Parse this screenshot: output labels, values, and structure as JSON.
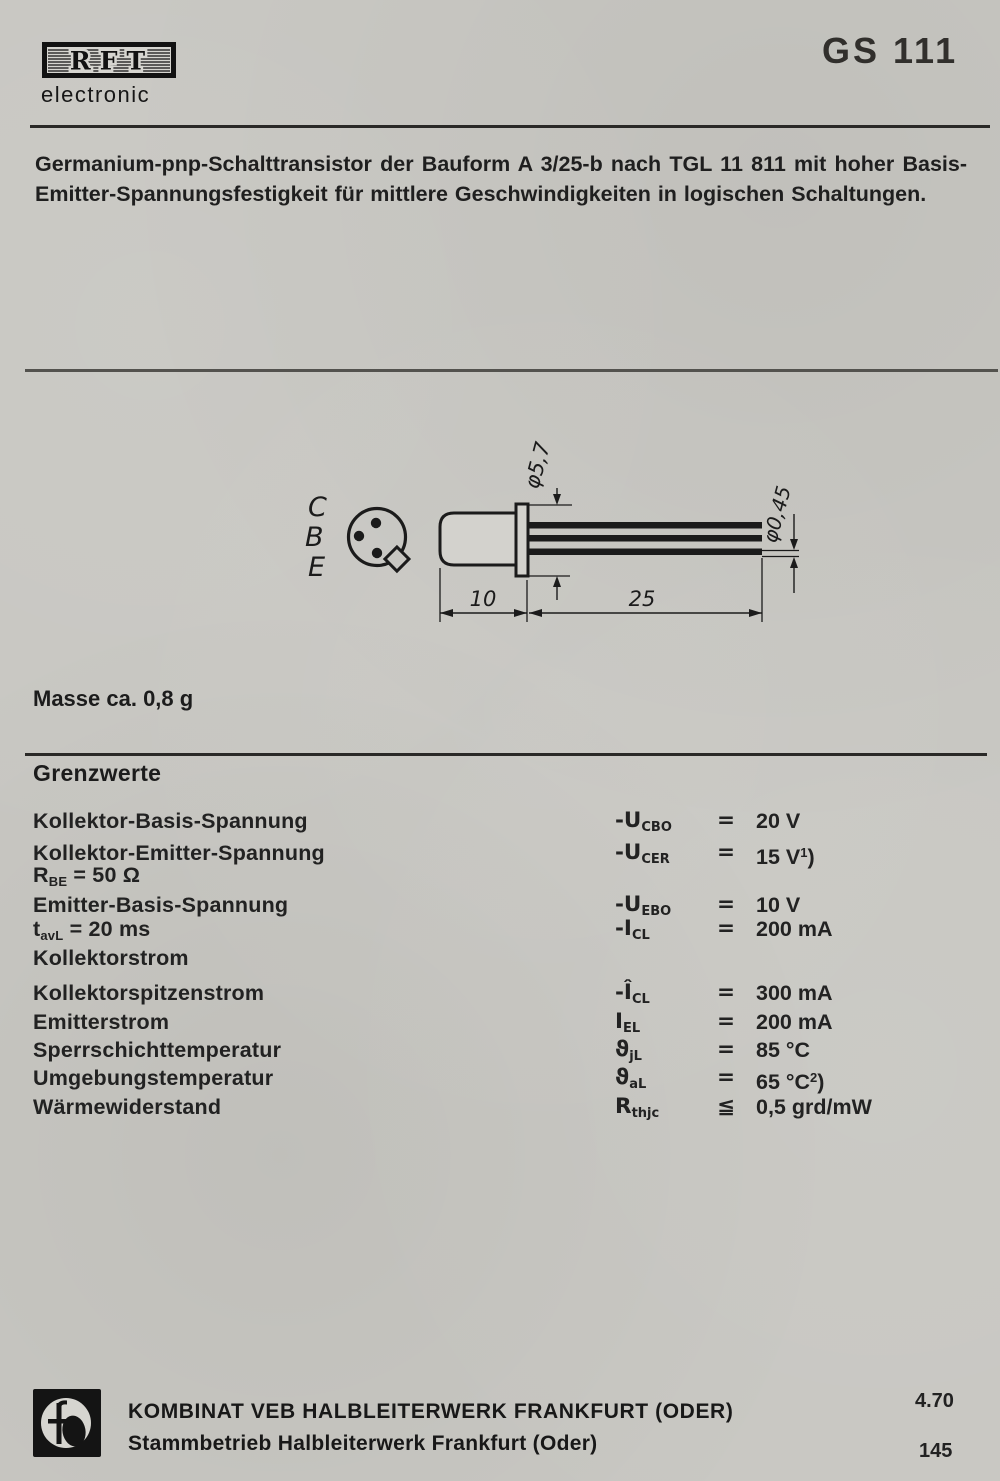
{
  "header": {
    "brand": "RFT",
    "brand_sub": "electronic",
    "part_number": "GS 111"
  },
  "description": {
    "lines": [
      "Germanium-pnp-Schalttransistor der Bauform A 3/25-b nach TGL 11 811 mit hoher Basis-",
      "Emitter-Spannungsfestigkeit für mittlere Geschwindigkeiten in logischen Schaltungen."
    ]
  },
  "diagram": {
    "pin_labels": [
      "C",
      "B",
      "E"
    ],
    "flange_diameter": "φ5,7",
    "lead_diameter": "φ0,45",
    "body_length": "10",
    "lead_length": "25"
  },
  "mass_note": "Masse ca. 0,8 g",
  "limits": {
    "title": "Grenzwerte",
    "rows": [
      {
        "label": "Kollektor-Basis-Spannung",
        "symbol": "-U~CBO~",
        "sign": "=",
        "value": "20 V"
      },
      {
        "label": "Kollektor-Emitter-Spannung",
        "symbol": "-U~CER~",
        "sign": "=",
        "value": "15 V^1^)"
      },
      {
        "label": "R~BE~ = 50 Ω",
        "symbol": "",
        "sign": "",
        "value": ""
      },
      {
        "label": "Emitter-Basis-Spannung",
        "symbol": "-U~EBO~",
        "sign": "=",
        "value": "10 V"
      },
      {
        "label": "t~avL~ = 20 ms",
        "symbol": "-I~CL~",
        "sign": "=",
        "value": "200 mA"
      },
      {
        "label": "Kollektorstrom",
        "symbol": "",
        "sign": "",
        "value": ""
      },
      {
        "label": "Kollektorspitzenstrom",
        "symbol": "-Î~CL~",
        "sign": "=",
        "value": "300 mA"
      },
      {
        "label": "Emitterstrom",
        "symbol": "I~EL~",
        "sign": "=",
        "value": "200 mA"
      },
      {
        "label": "Sperrschichttemperatur",
        "symbol": "ϑ~jL~",
        "sign": "=",
        "value": "85 °C"
      },
      {
        "label": "Umgebungstemperatur",
        "symbol": "ϑ~aL~",
        "sign": "=",
        "value": "65 °C^2^)"
      },
      {
        "label": "Wärmewiderstand",
        "symbol": "R~thjc~",
        "sign": "≦",
        "value": "0,5 grd/mW"
      }
    ]
  },
  "footer": {
    "company_line1": "KOMBINAT VEB HALBLEITERWERK FRANKFURT (ODER)",
    "company_line2": "Stammbetrieb Halbleiterwerk Frankfurt (Oder)",
    "date_code": "4.70",
    "page_number": "145"
  }
}
